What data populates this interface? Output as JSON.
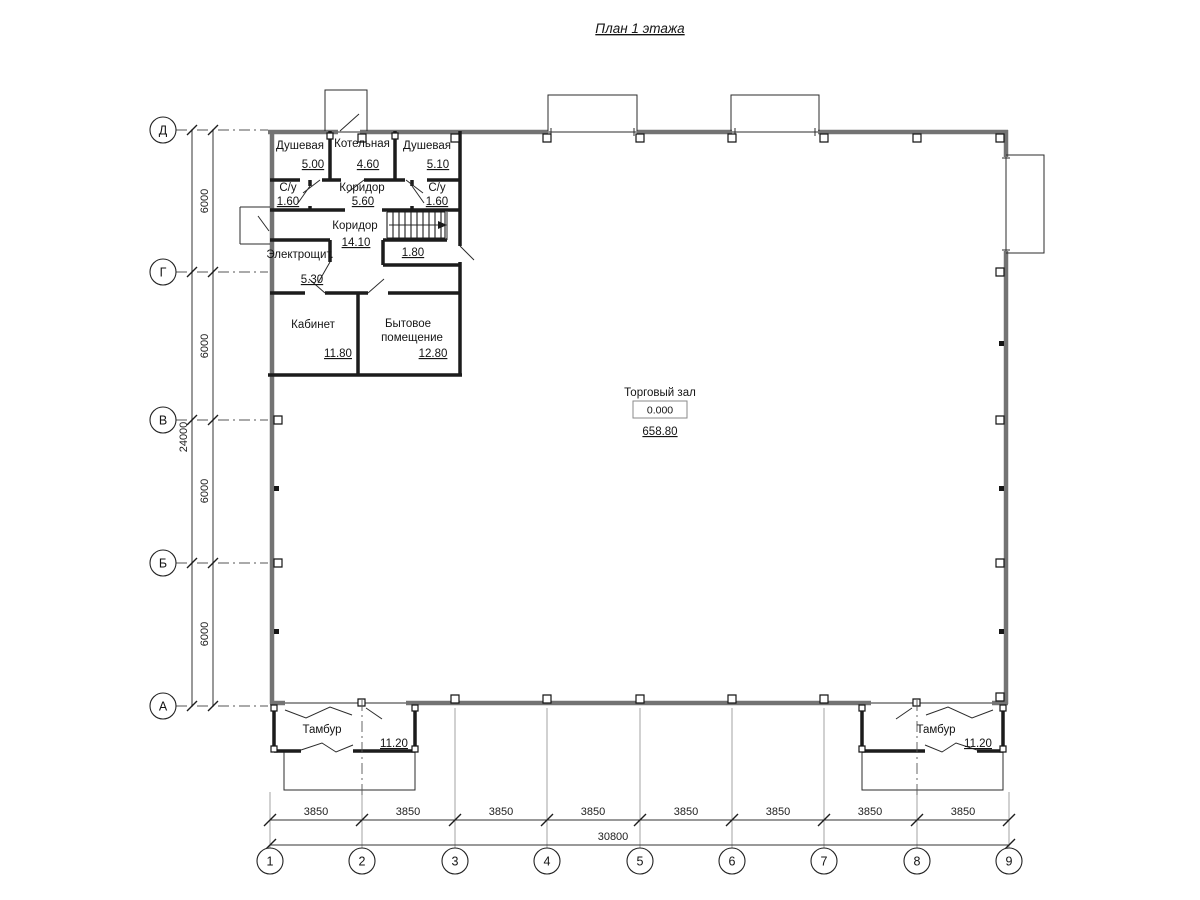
{
  "title": "План 1 этажа",
  "rooms": {
    "shower_left": {
      "name": "Душевая",
      "area": "5.00"
    },
    "boiler": {
      "name": "Котельная",
      "area": "4.60"
    },
    "shower_right": {
      "name": "Душевая",
      "area": "5.10"
    },
    "wc_left": {
      "name": "С/у",
      "area": "1.60"
    },
    "corridor_small": {
      "name": "Коридор",
      "area": "5.60"
    },
    "wc_right": {
      "name": "С/у",
      "area": "1.60"
    },
    "corridor_main": {
      "name": "Коридор",
      "area": "14.10"
    },
    "stair_room": {
      "area": "1.80"
    },
    "electrical": {
      "name": "Электрощит.",
      "area": "5.30"
    },
    "office": {
      "name": "Кабинет",
      "area": "11.80"
    },
    "utility": {
      "name_line1": "Бытовое",
      "name_line2": "помещение",
      "area": "12.80"
    },
    "hall": {
      "name": "Торговый зал",
      "level": "0.000",
      "area": "658.80"
    },
    "vestibule_left": {
      "name": "Тамбур",
      "area": "11.20"
    },
    "vestibule_right": {
      "name": "Тамбур",
      "area": "11.20"
    }
  },
  "axes": {
    "rows": [
      "Д",
      "Г",
      "В",
      "Б",
      "А"
    ],
    "cols": [
      "1",
      "2",
      "3",
      "4",
      "5",
      "6",
      "7",
      "8",
      "9"
    ]
  },
  "dims": {
    "h_segments": [
      "3850",
      "3850",
      "3850",
      "3850",
      "3850",
      "3850",
      "3850",
      "3850"
    ],
    "h_total": "30800",
    "v_segments": [
      "6000",
      "6000",
      "6000",
      "6000"
    ],
    "v_total": "24000"
  },
  "colors": {
    "wall_exterior": "#737373",
    "wall_interior": "#1c1c1c",
    "axis_line": "#555555"
  }
}
